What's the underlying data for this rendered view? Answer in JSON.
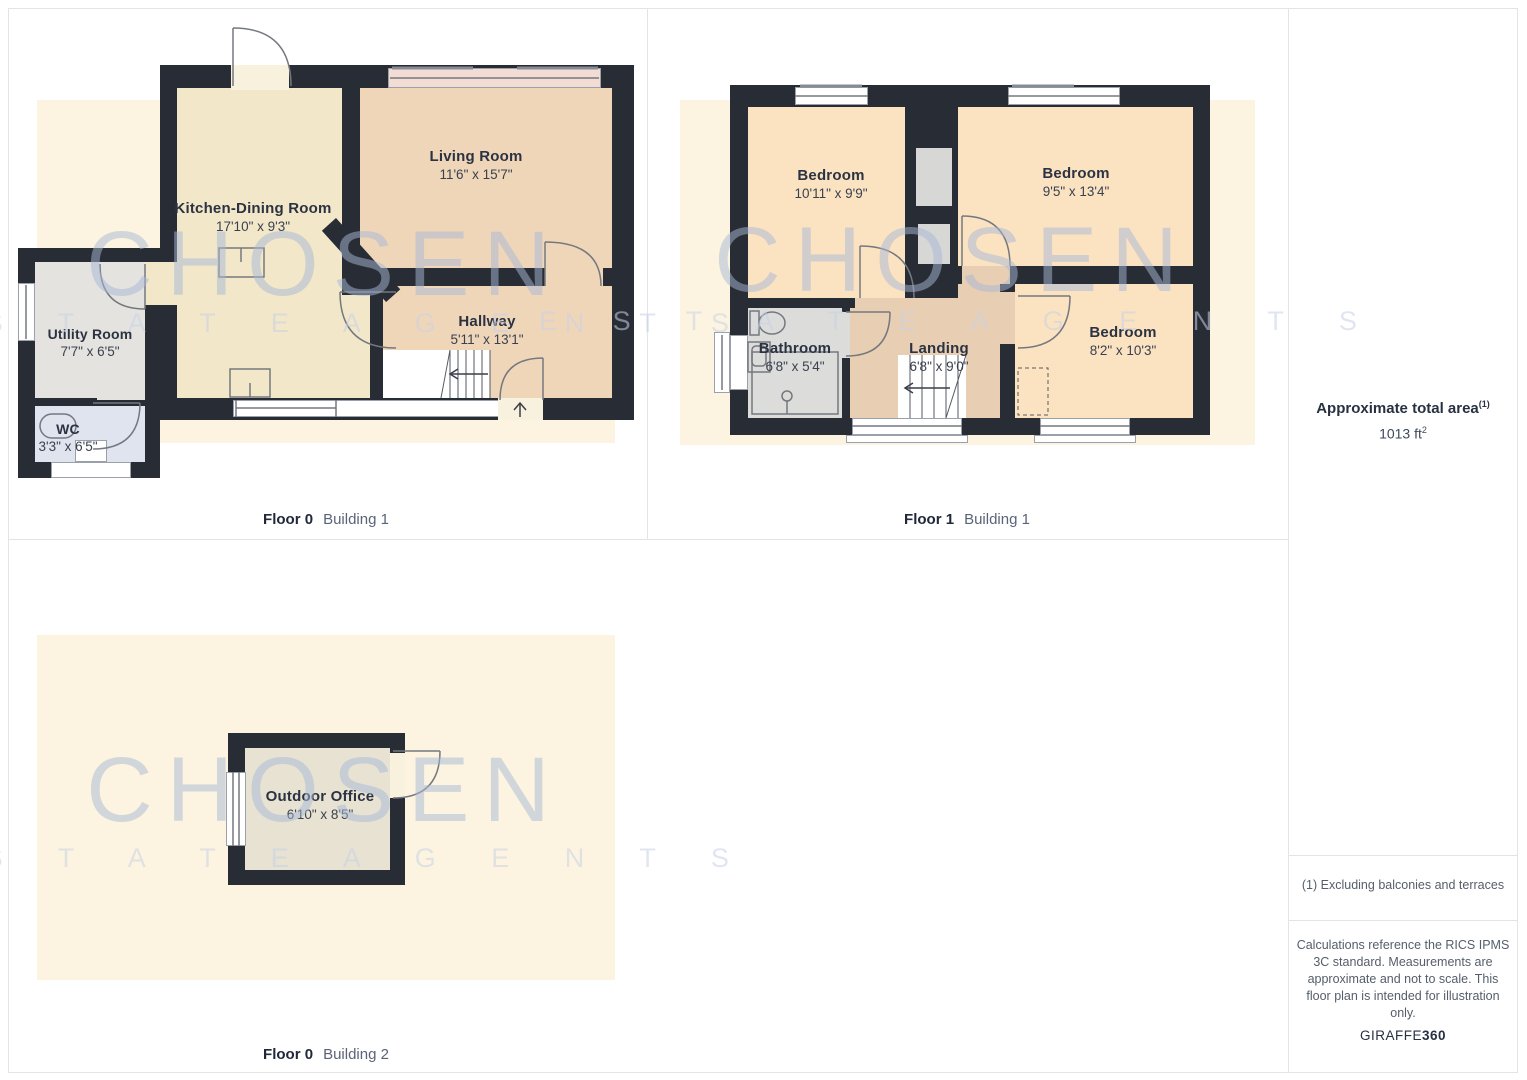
{
  "colors": {
    "border": "#e4e4e4",
    "wall": "#282c35",
    "site": "#fcf4e0",
    "kitchen": "#f2e7c9",
    "peach": "#f0d6b9",
    "bed": "#fbe3c2",
    "landing": "#e8cfb3",
    "utility": "#e4e3df",
    "wc": "#e0e4ef",
    "bath": "#dcdcda",
    "closet": "#d7d7d5",
    "office": "#e7e2d2",
    "bay": "#f3dcd4",
    "label": "#2b3342",
    "dims": "#39414f",
    "cap-bold": "#20283a",
    "cap-light": "#5a6477",
    "side-strong": "#273142",
    "side-text": "#3c4a5e",
    "muted": "#555e6b",
    "wm": "#a8b9d7",
    "wm2": "#c8d2e6"
  },
  "watermark": {
    "line1": "CHOSEN",
    "line2": "E S T A T E   A G E N T S"
  },
  "plans": {
    "f0b1": {
      "caption_floor": "Floor 0",
      "caption_building": "Building 1",
      "rooms": {
        "kitchen": {
          "name": "Kitchen-Dining Room",
          "dims": "17'10\" x 9'3\""
        },
        "living": {
          "name": "Living Room",
          "dims": "11'6\" x 15'7\""
        },
        "hallway": {
          "name": "Hallway",
          "dims": "5'11\" x 13'1\""
        },
        "utility": {
          "name": "Utility Room",
          "dims": "7'7\" x 6'5\""
        },
        "wc": {
          "name": "WC",
          "dims": "3'3\" x 6'5\""
        }
      }
    },
    "f1b1": {
      "caption_floor": "Floor 1",
      "caption_building": "Building 1",
      "rooms": {
        "bedroom1": {
          "name": "Bedroom",
          "dims": "10'11\" x 9'9\""
        },
        "bedroom2": {
          "name": "Bedroom",
          "dims": "9'5\" x 13'4\""
        },
        "bedroom3": {
          "name": "Bedroom",
          "dims": "8'2\" x 10'3\""
        },
        "bathroom": {
          "name": "Bathroom",
          "dims": "6'8\" x 5'4\""
        },
        "landing": {
          "name": "Landing",
          "dims": "6'8\" x 9'0\""
        }
      }
    },
    "f0b2": {
      "caption_floor": "Floor 0",
      "caption_building": "Building 2",
      "rooms": {
        "office": {
          "name": "Outdoor Office",
          "dims": "6'10\" x 8'5\""
        }
      }
    }
  },
  "sidebar": {
    "area_label": "Approximate total area",
    "area_footnote_marker": "(1)",
    "area_value": "1013 ft",
    "area_value_sup": "2",
    "footnote": "(1) Excluding balconies and terraces",
    "disclaimer": "Calculations reference the RICS IPMS 3C standard. Measurements are approximate and not to scale. This floor plan is intended for illustration only.",
    "brand_name": "GIRAFFE",
    "brand_suffix": "360"
  }
}
